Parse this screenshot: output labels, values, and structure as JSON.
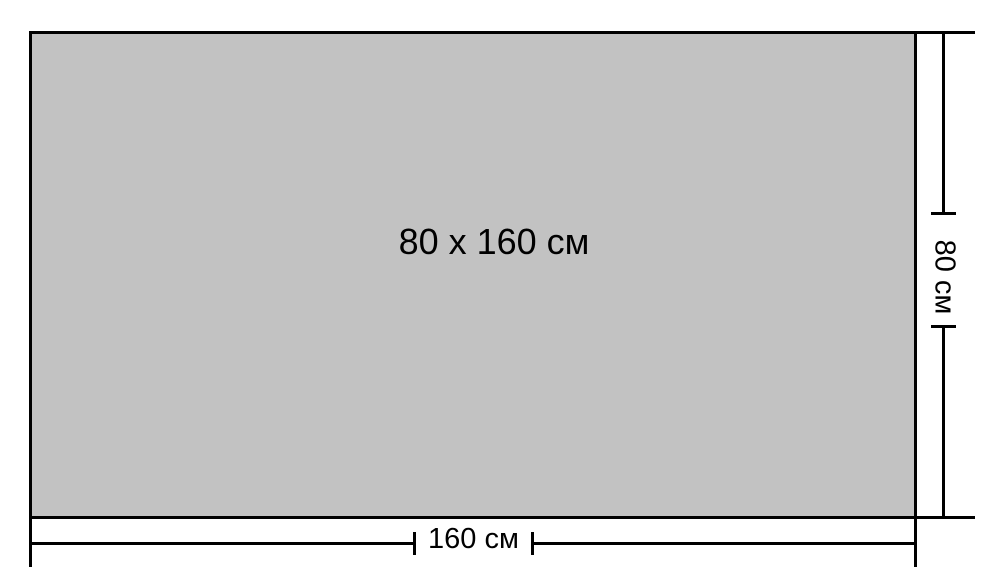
{
  "diagram": {
    "rectangle_label": "80 x 160 см",
    "dimensions": {
      "height": {
        "label": "80 см",
        "value_cm": 80
      },
      "width": {
        "label": "160 см",
        "value_cm": 160
      }
    },
    "colors": {
      "fill": "#c2c2c2",
      "stroke": "#000000",
      "background": "#ffffff"
    }
  }
}
